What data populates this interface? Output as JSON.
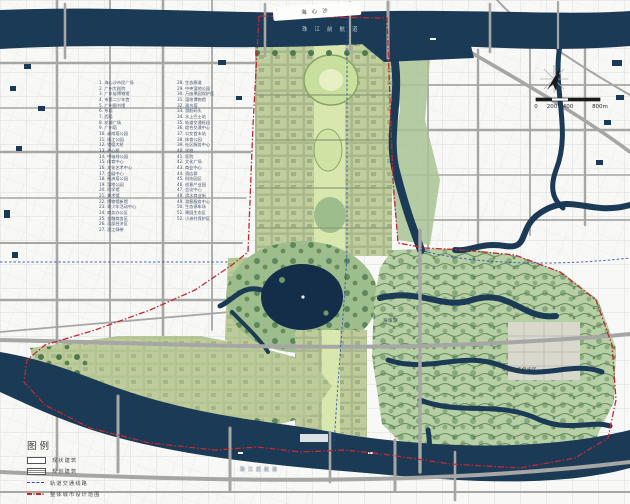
{
  "map": {
    "labels": {
      "island": "海心沙",
      "front_channel": "珠江前航道",
      "rear_channel": "珠江后航道",
      "lake": "海珠湖",
      "orchard": "果园生态保护区"
    },
    "colors": {
      "water": "#1b3a55",
      "lake": "#142e49",
      "road": "#a6a6a4",
      "urban_green": "#b9c69a",
      "axis_green": "#d8e7ae",
      "wetland_green": "#b7cfa4",
      "tree_green": "#4d7a4e",
      "boundary_red": "#c12a33",
      "metro_blue": "#2a4db0"
    }
  },
  "legend": {
    "title": "图例",
    "items": [
      {
        "label": "现状建筑",
        "swatch": "planned-building"
      },
      {
        "label": "规划建筑",
        "swatch": "existing-building"
      },
      {
        "label": "轨道交通线路",
        "swatch": "rail-transit-line"
      },
      {
        "label": "整体城市设计范围",
        "swatch": "urban-design-boundary"
      }
    ]
  },
  "scalebar": {
    "ticks": [
      "0",
      "200",
      "400",
      "800m"
    ]
  },
  "landmark_list": {
    "col1": [
      "1. 海心沙市民广场",
      "2. 广州大剧院",
      "3. 广东省博物馆",
      "4. 市第二少年宫",
      "5. 广州图书馆",
      "6. 东塔",
      "7. 西塔",
      "8. 花城广场",
      "9. 广州塔",
      "10. 赤岗塔公园",
      "11. 珠江公园",
      "12. 猎德大桥",
      "13. 海心桥",
      "14. 中轴线公园",
      "15. 体育中心",
      "16. 文化艺术中心",
      "17. 会展中心",
      "18. 琶洲塔公园",
      "19. 湿地公园",
      "20. 科学馆",
      "21. 美术馆",
      "22. 博物馆新馆",
      "23. 青少年活动中心",
      "24. 商务办公区",
      "25. 金融商务区",
      "26. 总部经济区",
      "27. 滨江绿带"
    ],
    "col2": [
      "28. 生态廊道",
      "29. 中央湿地公园",
      "30. 万亩果园保护区",
      "31. 湿地博物馆",
      "32. 观鸟塔",
      "33. 游船码头",
      "34. 水上巴士站",
      "35. 轨道交通枢纽",
      "36. 综合交通中心",
      "37. 公交首末站",
      "38. 体育公园",
      "39. 社区服务中心",
      "40. 学校",
      "41. 医院",
      "42. 文化广场",
      "43. 商业中心",
      "44. 酒店群",
      "45. 科技园区",
      "46. 创意产业园",
      "47. 会议中心",
      "48. 滨水商业街",
      "49. 游客服务中心",
      "50. 生态停车场",
      "51. 果园生态区",
      "52. 小洲村保护区"
    ]
  }
}
